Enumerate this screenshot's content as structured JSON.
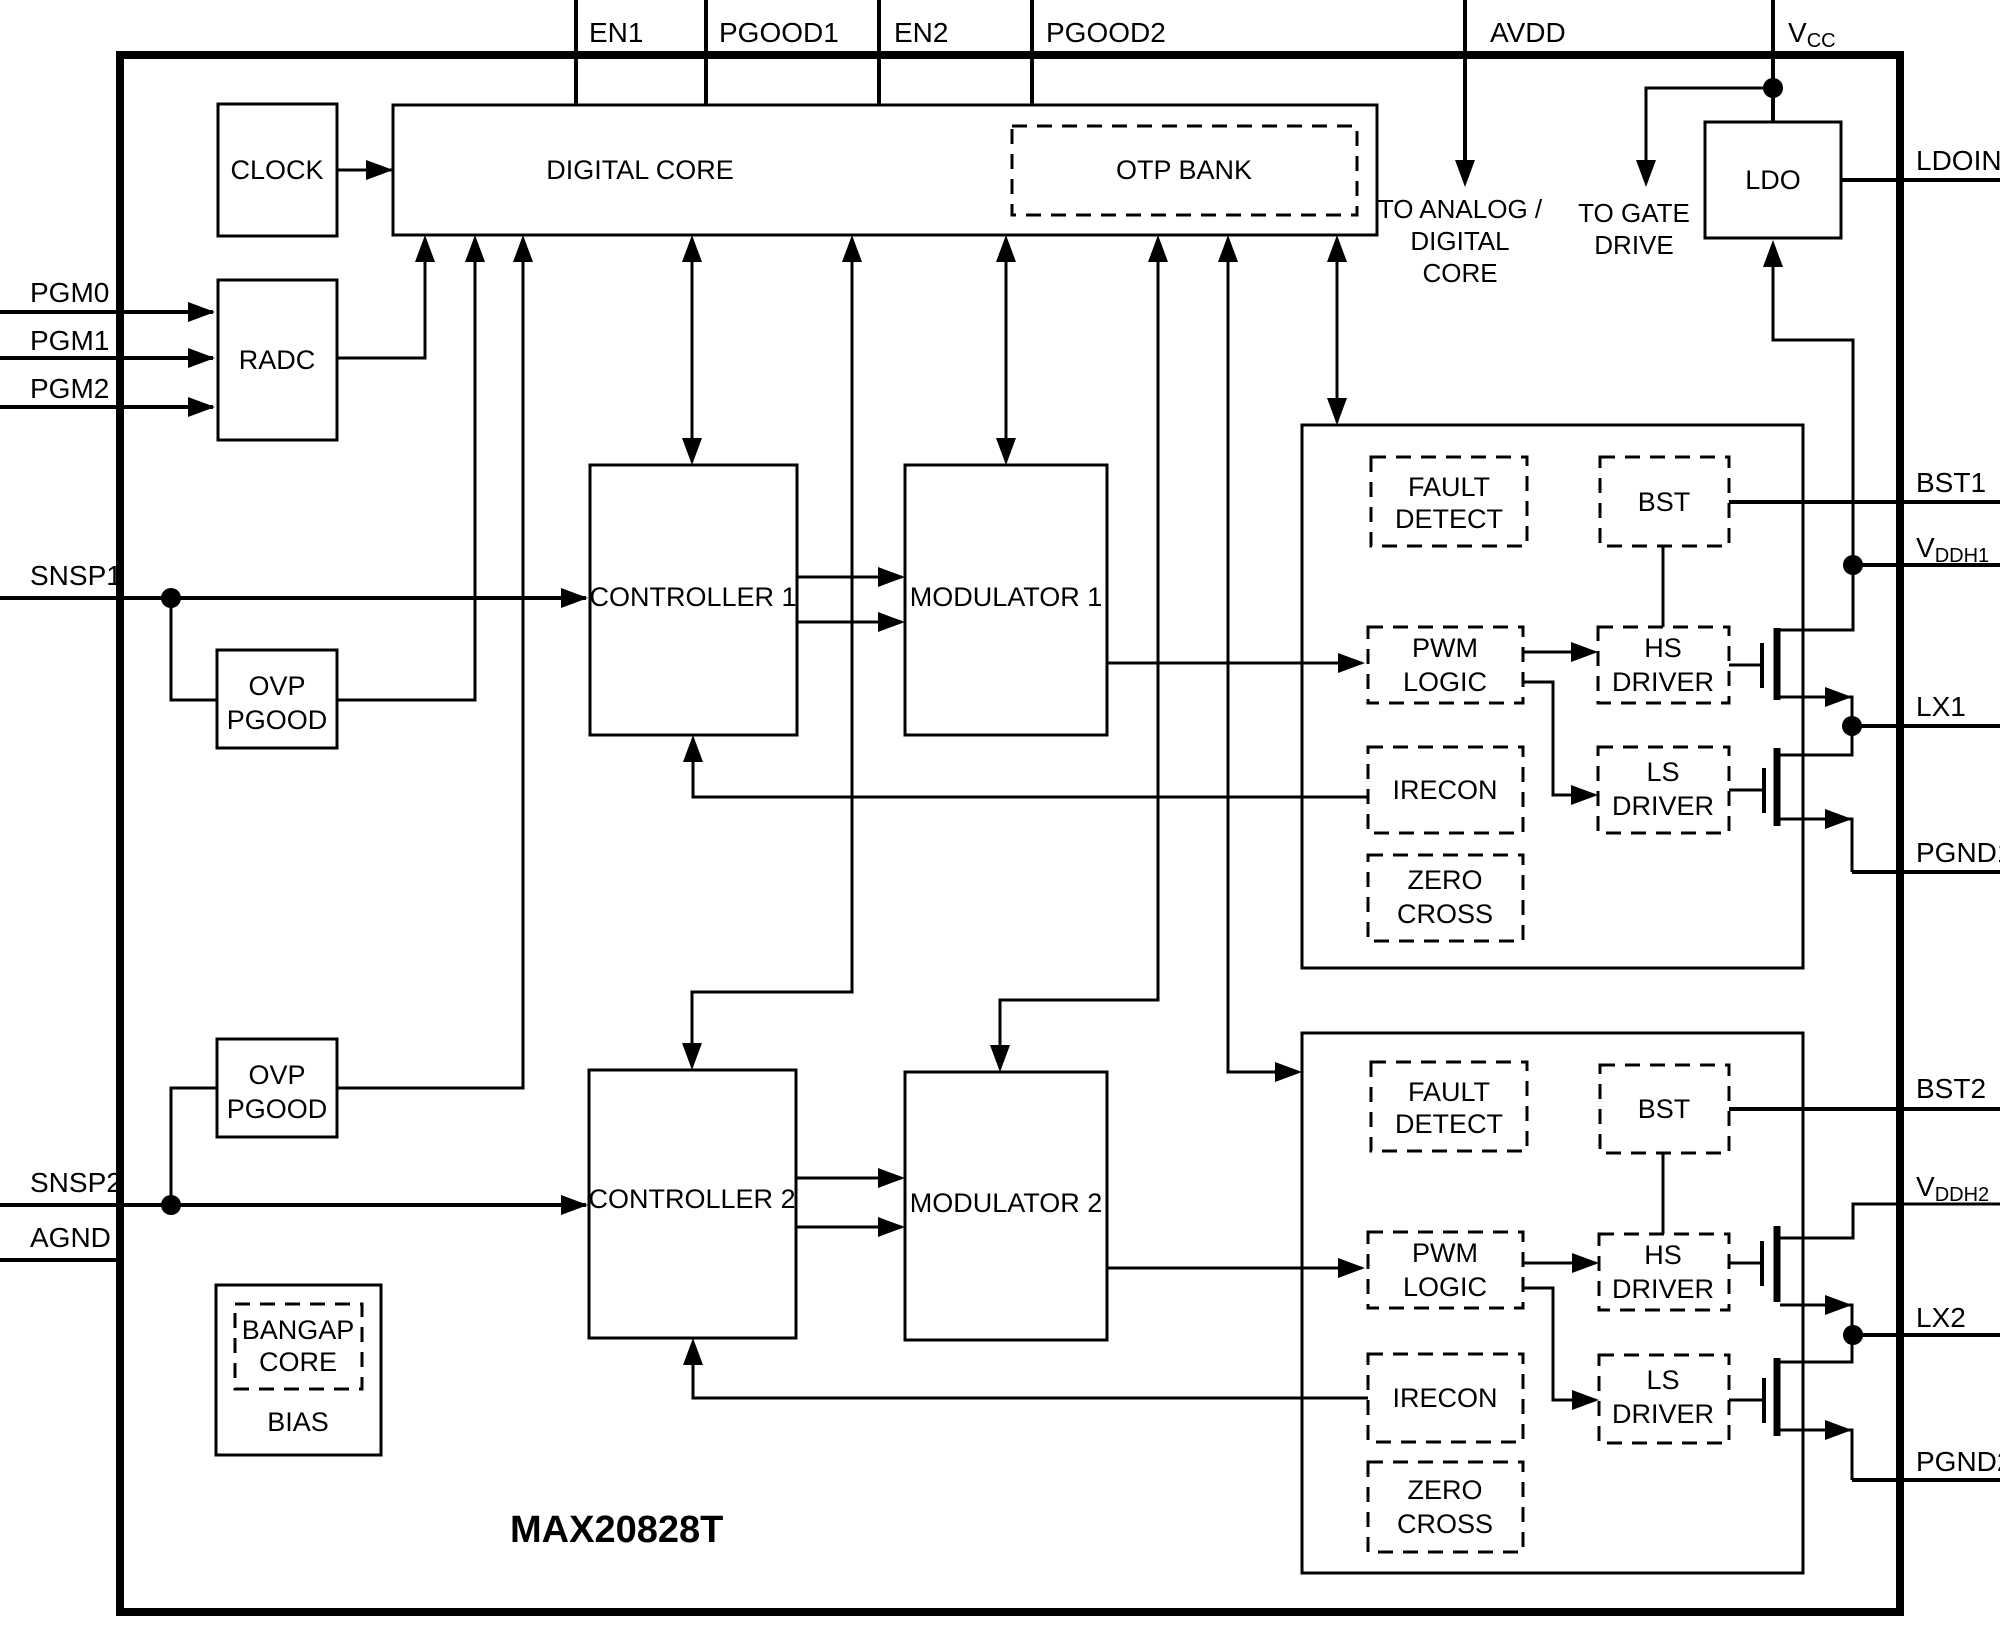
{
  "chip": {
    "part_number": "MAX20828T",
    "line_color": "#000000",
    "background": "#ffffff"
  },
  "pins": {
    "top": [
      {
        "label": "EN1"
      },
      {
        "label": "PGOOD1"
      },
      {
        "label": "EN2"
      },
      {
        "label": "PGOOD2"
      },
      {
        "label": "AVDD"
      },
      {
        "label": "V",
        "sub": "CC"
      }
    ],
    "left": [
      {
        "label": "PGM0"
      },
      {
        "label": "PGM1"
      },
      {
        "label": "PGM2"
      },
      {
        "label": "SNSP1"
      },
      {
        "label": "SNSP2"
      },
      {
        "label": "AGND"
      }
    ],
    "right": [
      {
        "label": "LDOIN"
      },
      {
        "label": "BST1"
      },
      {
        "label": "V",
        "sub": "DDH1"
      },
      {
        "label": "LX1"
      },
      {
        "label": "PGND1"
      },
      {
        "label": "BST2"
      },
      {
        "label": "V",
        "sub": "DDH2"
      },
      {
        "label": "LX2"
      },
      {
        "label": "PGND2"
      }
    ]
  },
  "blocks": {
    "clock": {
      "label": "CLOCK"
    },
    "digital_core": {
      "label": "DIGITAL CORE"
    },
    "otp_bank": {
      "label": "OTP BANK"
    },
    "radc": {
      "label": "RADC"
    },
    "ovp_pgood_1": {
      "line1": "OVP",
      "line2": "PGOOD"
    },
    "ovp_pgood_2": {
      "line1": "OVP",
      "line2": "PGOOD"
    },
    "controller_1": {
      "label": "CONTROLLER 1"
    },
    "modulator_1": {
      "label": "MODULATOR 1"
    },
    "controller_2": {
      "label": "CONTROLLER 2"
    },
    "modulator_2": {
      "label": "MODULATOR 2"
    },
    "ldo": {
      "label": "LDO"
    },
    "bandgap": {
      "core_line1": "BANGAP",
      "core_line2": "CORE",
      "bias": "BIAS"
    }
  },
  "driver_section_1": {
    "fault_detect": {
      "line1": "FAULT",
      "line2": "DETECT"
    },
    "bst": {
      "label": "BST"
    },
    "pwm_logic": {
      "line1": "PWM",
      "line2": "LOGIC"
    },
    "hs_driver": {
      "line1": "HS",
      "line2": "DRIVER"
    },
    "irecon": {
      "label": "IRECON"
    },
    "ls_driver": {
      "line1": "LS",
      "line2": "DRIVER"
    },
    "zero_cross": {
      "line1": "ZERO",
      "line2": "CROSS"
    }
  },
  "driver_section_2": {
    "fault_detect": {
      "line1": "FAULT",
      "line2": "DETECT"
    },
    "bst": {
      "label": "BST"
    },
    "pwm_logic": {
      "line1": "PWM",
      "line2": "LOGIC"
    },
    "hs_driver": {
      "line1": "HS",
      "line2": "DRIVER"
    },
    "irecon": {
      "label": "IRECON"
    },
    "ls_driver": {
      "line1": "LS",
      "line2": "DRIVER"
    },
    "zero_cross": {
      "line1": "ZERO",
      "line2": "CROSS"
    }
  },
  "annotations": {
    "to_analog_digital_core": {
      "line1": "TO ANALOG /",
      "line2": "DIGITAL",
      "line3": "CORE"
    },
    "to_gate_drive": {
      "line1": "TO GATE",
      "line2": "DRIVE"
    }
  }
}
